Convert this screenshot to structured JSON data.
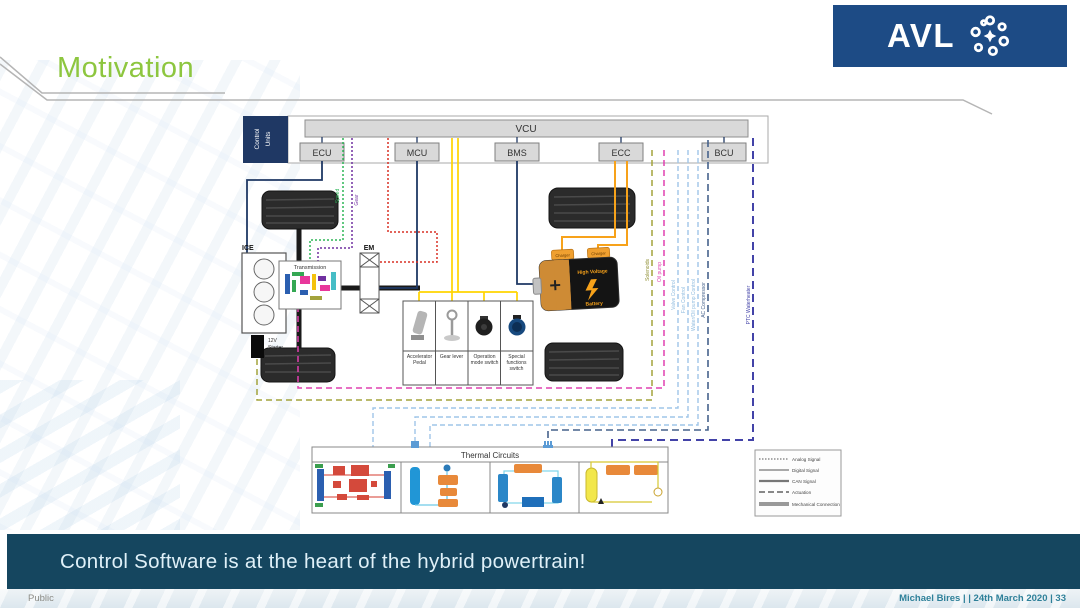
{
  "slide": {
    "title": "Motivation",
    "banner": "Control Software is at the heart of the hybrid powertrain!",
    "footer_left": "Public",
    "footer_right": "Michael Bires |  | 24th March 2020 | 33"
  },
  "logo": {
    "text": "AVL"
  },
  "control_units": {
    "label_line1": "Control",
    "label_line2": "Units",
    "vcu": "VCU",
    "units": [
      "ECU",
      "MCU",
      "BMS",
      "ECC",
      "BCU"
    ]
  },
  "components": {
    "ice": "ICE",
    "starter_line1": "12V",
    "starter_line2": "Starter",
    "transmission": "Transmission",
    "em": "EM",
    "battery_line1": "High Voltage",
    "battery_line2": "Battery",
    "battery_tab": "Charger"
  },
  "driver_controls": {
    "items": [
      "Accelerator Pedal",
      "Gear lever",
      "Operation mode switch",
      "Special functions switch"
    ]
  },
  "signals": {
    "speed": "Speed",
    "gear": "Gear",
    "solenoids": "Solenoids",
    "oil_pump": "Oil pump",
    "valve_control": "Valve Control",
    "fan_control": "Fan Control",
    "water_oil_pump_control": "Water/Oil pump Control",
    "ac_compressor": "AC Compressor",
    "ptc_waterheater": "PTC Waterheater"
  },
  "thermal": {
    "title": "Thermal Circuits"
  },
  "legend": {
    "items": [
      "Analog Signal",
      "Digital Signal",
      "CAN Signal",
      "Actuation",
      "Mechanical Connection"
    ]
  },
  "colors": {
    "title_green": "#8DC63F",
    "logo_blue": "#1D4B85",
    "navy": "#1F3864",
    "banner_teal": "#15465F",
    "footer_teal": "#2E8099",
    "yellow": "#FFD400",
    "orange": "#F7A21A",
    "magenta": "#E040B0",
    "olive": "#A3A33C",
    "light_blue": "#9FC5E8",
    "steel_blue": "#46628C",
    "ptc_navy": "#4343A8",
    "green": "#2DB557",
    "purple": "#7030A0",
    "red": "#D93025"
  }
}
